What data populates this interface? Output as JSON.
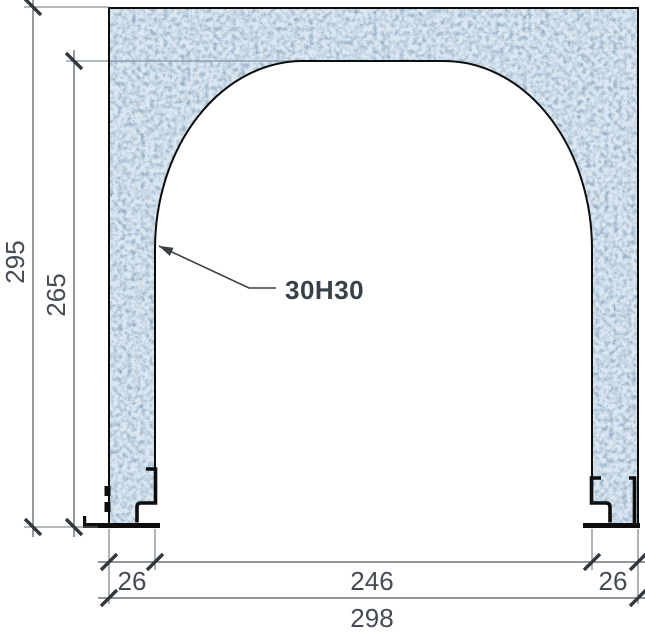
{
  "drawing": {
    "annotation": {
      "label": "30H30"
    },
    "dimensions": {
      "total_height": "295",
      "opening_height": "265",
      "left_wall_thickness": "26",
      "opening_width": "246",
      "right_wall_thickness": "26",
      "total_width": "298"
    },
    "colors": {
      "background": "#ffffff",
      "concrete_fill": "#dbe7f1",
      "speckle_soft": "#7394b3",
      "speckle_dark": "#335170",
      "outline": "#0d0d0d",
      "dimension_line": "#4d575f",
      "tick": "#33383e",
      "dimension_text": "#454b52",
      "annotation_text": "#3a4049",
      "steel_extension_line": "#7d93a5"
    }
  }
}
